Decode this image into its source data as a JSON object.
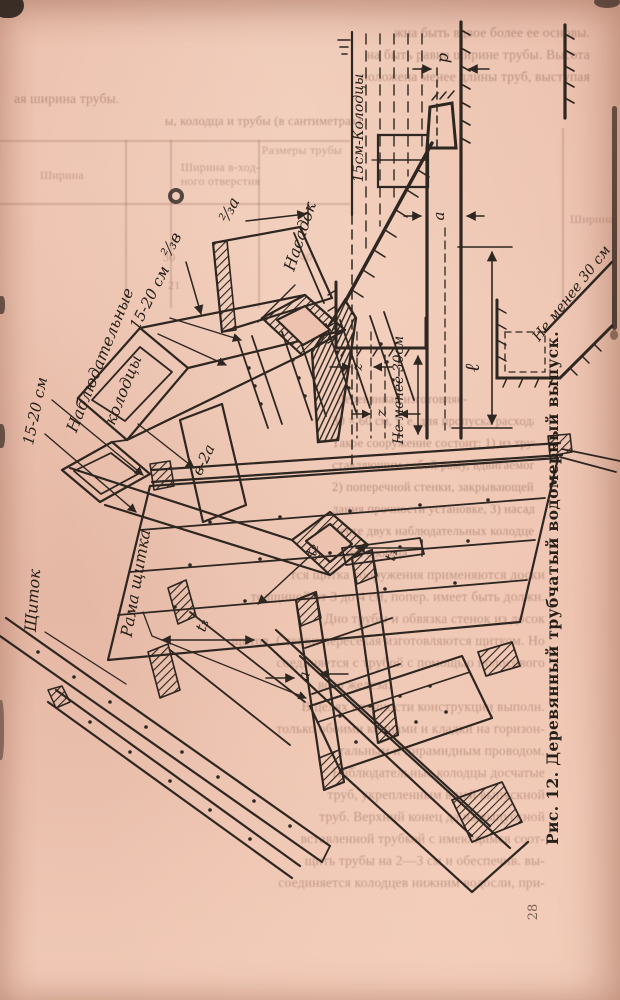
{
  "page": {
    "number": "28",
    "caption": "Рис. 12. Деревянный трубчатый водомерный выпуск."
  },
  "labels": {
    "observation_wells_1": "Наблюдательные",
    "observation_wells_2": "колодцы",
    "dim_15_20_a": "15-20 см",
    "dim_15_20_b": "15-20 см",
    "two_thirds_b": "⅔в",
    "two_thirds_a": "⅔а",
    "nozzle": "Насадок",
    "b_minus_2a": "в-2а",
    "t1": "t₁",
    "t2": "t₂",
    "t3": "t₃",
    "a_iso": "а",
    "shield": "Щиток",
    "shield_frame": "Рама щитка",
    "wells_15cm": "15см-Колодцы",
    "p": "р",
    "a_section": "а",
    "not_less_30_a": "Не менее 30см",
    "ell": "ℓ",
    "not_less_30_b": "Не менее 30 см",
    "z1": "z",
    "z2": "z"
  },
  "ghost": {
    "lines": [
      "жна быть вдвое более ее основы.",
      "на быть равна ширине трубы. Высота",
      "положена менее длины труб, выступая",
      "ая ширина трубы.",
      "ы, колодца и трубы (в сантиметрах).",
      "Ширина",
      "Ширина в-ход-",
      "ного отверстия",
      "Размеры трубы",
      "Ширина",
      "30",
      "40",
      "21",
      "Деревянная изготовляе-",
      "30 × 60 см, т. е. для пропуска расхода воды",
      "Такое сооружение состоит: 1) из трубы",
      "ставляющим собой раму, вдвигаемого регул.",
      "2) поперечной стенки, закрывающей откос",
      "дания прочности установке, 3) насадка и 4)",
      "месте двух наблюдательных колодцев, расп.",
      "садки сообща.",
      "тся щитка сооружения применяются доски",
      "толщиной от 3 до 4 см, попер. имеет быть должн.",
      "Дно трубы и обвязка стенок из досок",
      "щитов. Стенки пересекая изготовляются щитком. Но",
      "соединяется с трубой с помощью полосового",
      "вого железа.",
      "В целях прочности конструкции выполн.",
      "только обоими концами и кладки на горизон-",
      "тальным и пирамидным проводом.",
      "Наблюдательные колодцы досчатые",
      "труб, укрепленным в ней выпускной",
      "труб. Верхний конец да на выпускной",
      "вставленной трубкой с имеющимся соот-",
      "щить трубы на 2—3 см и обеспечив. вы-",
      "соединяется колодцев нижним водосли, при-"
    ]
  }
}
